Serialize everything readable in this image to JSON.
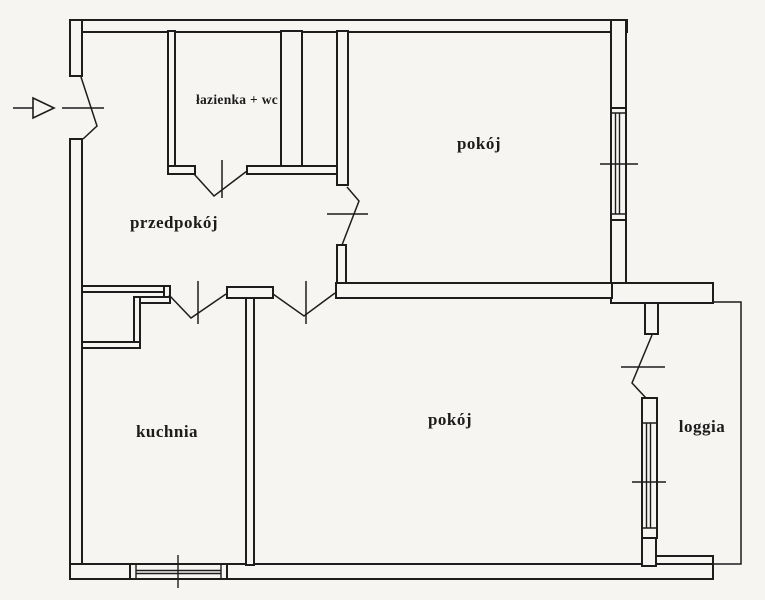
{
  "rooms": [
    {
      "name": "przedpokoj",
      "label": "przedpokój"
    },
    {
      "name": "lazienka-wc",
      "label": "łazienka + wc"
    },
    {
      "name": "pokoj-top",
      "label": "pokój"
    },
    {
      "name": "kuchnia",
      "label": "kuchnia"
    },
    {
      "name": "pokoj-bottom",
      "label": "pokój"
    },
    {
      "name": "loggia",
      "label": "loggia"
    }
  ],
  "entry": {
    "icon": "entry-arrow-icon"
  },
  "colors": {
    "ink": "#1d1d1d",
    "paper": "#f6f5f1"
  }
}
